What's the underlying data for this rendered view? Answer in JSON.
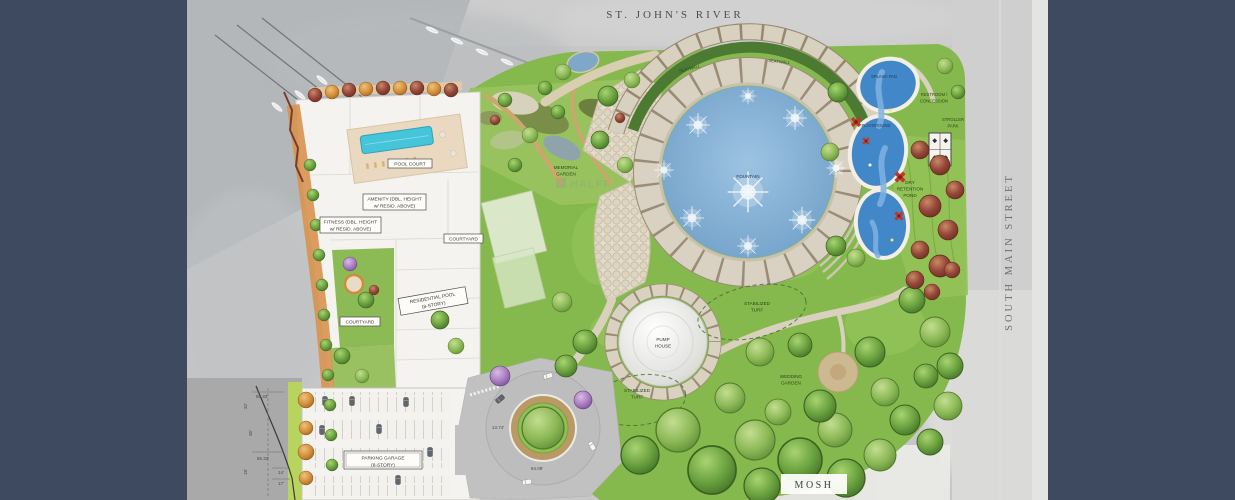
{
  "streets": {
    "top": "ST. JOHN'S RIVER",
    "right": "SOUTH MAIN STREET",
    "bottom_building": "MOSH"
  },
  "watermark": "HALFF",
  "labels": {
    "seatwall_left": "SEATWALL",
    "seatwall_right": "SEATWALL",
    "fountain": "FOUNTAIN",
    "memorial_garden": [
      "MEMORIAL",
      "GARDEN"
    ],
    "pool_court": "POOL COURT",
    "amenity": [
      "AMENITY (DBL. HEIGHT",
      "w/ RESID. ABOVE)"
    ],
    "fitness": [
      "FITNESS (DBL. HEIGHT",
      "w/ RESID. ABOVE)"
    ],
    "courtyard_upper": "COURTYARD",
    "courtyard_lower": "COURTYARD",
    "residential_pool": [
      "RESIDENTIAL POOL",
      "(8-STORY)"
    ],
    "parking_garage": [
      "PARKING GARAGE",
      "(8-STORY)"
    ],
    "pump_house": [
      "PUMP",
      "HOUSE"
    ],
    "stabilized_turf_upper": [
      "STABILIZED",
      "TURF"
    ],
    "stabilized_turf_lower": [
      "STABILIZED",
      "TURF"
    ],
    "wedding_garden": [
      "WEDDING",
      "GARDEN"
    ],
    "splash_pad": "SPLASH PAD",
    "playground": "PLAYGROUND",
    "restroom_concession": [
      "RESTROOM /",
      "CONCESSION"
    ],
    "stroller_park": [
      "STROLLER",
      "PARK"
    ],
    "dry_retention_pond": [
      "DRY",
      "RETENTION",
      "POND"
    ]
  },
  "dimensions": {
    "d1": "55.33'",
    "d2": "32'",
    "d3": "35'",
    "d4": "55.33'",
    "d5": "18'",
    "d6": "14'",
    "d7": "17'",
    "d8": "13.74'",
    "d9": "64.08'"
  },
  "palette": {
    "margin_bar": "#3E4A5F",
    "lawn_green": "#86B94D",
    "fountain_water": "#6D9DC6",
    "playground_blue": "#4287C8",
    "paver_tan": "#D9D2C2",
    "pool_teal": "#45C4DA",
    "retention_tree_red": "#8F4536",
    "aerial_gray": "#C7C7C7"
  }
}
